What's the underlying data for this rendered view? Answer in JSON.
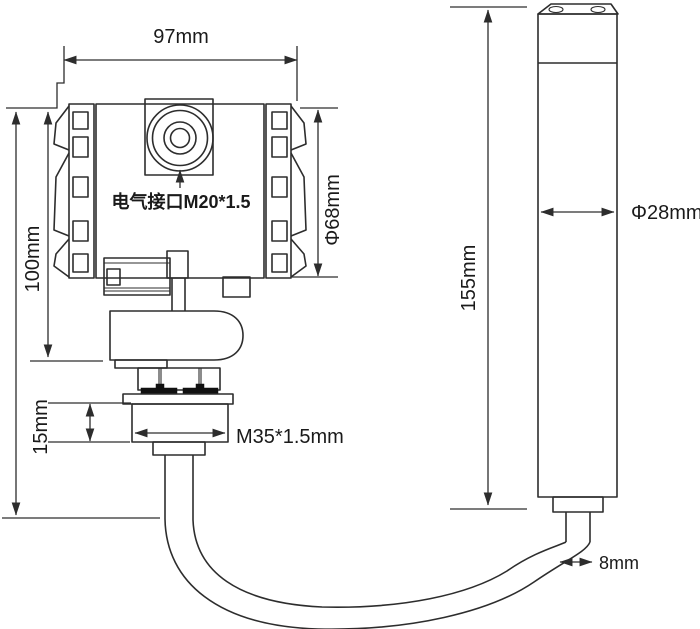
{
  "diagram": {
    "type": "technical-dimension-drawing",
    "subject": "pressure-level-transmitter-with-submersible-probe",
    "background_color": "#ffffff",
    "line_color": "#2d2d2d",
    "text_color": "#1a1a1a",
    "gasket_color": "#111111",
    "labels": {
      "housing_width": "97mm",
      "housing_height": "100mm",
      "housing_diameter": "Φ68mm",
      "electrical_interface": "电气接口M20*1.5",
      "thread_height": "15mm",
      "thread_spec": "M35*1.5mm",
      "probe_length": "155mm",
      "probe_diameter": "Φ28mm",
      "cable_diameter": "8mm"
    }
  }
}
